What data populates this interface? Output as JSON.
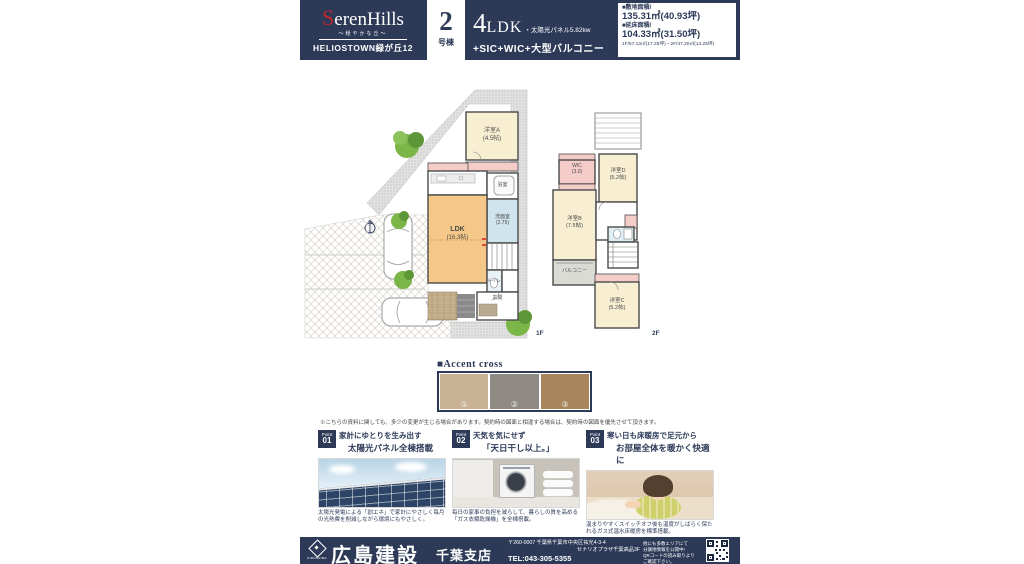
{
  "colors": {
    "navy": "#2c3a58",
    "brand_red": "#c0272d",
    "room_cream": "#f8efd3",
    "ldk_orange": "#f5c88a",
    "closet_pink": "#f5cdc8",
    "wet_area_blue": "#cfe4ec"
  },
  "header": {
    "brand_initial": "S",
    "brand_rest": "erenHills",
    "brand_tagline": "〜穏やかな丘〜",
    "brand_series": "HELIOSTOWN緑が丘12",
    "unit_number": "2",
    "unit_suffix": "号棟",
    "plan_number": "4",
    "plan_type": "LDK",
    "plan_solar": "・太陽光パネル5.82kw",
    "plan_features": "+SIC+WIC+大型バルコニー",
    "area_land_label": "■敷地面積/",
    "area_land_value": "135.31㎡(40.93坪)",
    "area_floor_label": "■延床面積/",
    "area_floor_value": "104.33㎡(31.50坪)",
    "area_detail": "1F/57.13㎡(17.25坪)・2F/47.20㎡(14.25坪)"
  },
  "floorplan": {
    "f1_label": "1F",
    "f2_label": "2F",
    "f1_rooms": {
      "room_a": {
        "name": "洋室A",
        "size": "(4.5帖)"
      },
      "ldk": {
        "name": "LDK",
        "size": "(16.3帖)"
      },
      "bath": {
        "name": "浴室",
        "size": ""
      },
      "washroom": {
        "name": "洗面室",
        "size": "(2.75)"
      },
      "toilet": {
        "name": "トイレ",
        "size": ""
      },
      "entrance": {
        "name": "玄関",
        "size": ""
      }
    },
    "f2_rooms": {
      "wic": {
        "name": "WIC",
        "size": "(3.0)"
      },
      "room_d": {
        "name": "洋室D",
        "size": "(5.2帖)"
      },
      "room_b": {
        "name": "洋室B",
        "size": "(7.5帖)"
      },
      "balcony": {
        "name": "バルコニー",
        "size": ""
      },
      "room_c": {
        "name": "洋室C",
        "size": "(5.2帖)"
      }
    }
  },
  "accent": {
    "title": "■Accent cross",
    "swatches": [
      {
        "label": "①",
        "color": "#c9b394"
      },
      {
        "label": "②",
        "color": "#8f8a84"
      },
      {
        "label": "③",
        "color": "#a8855a"
      }
    ],
    "disclaimer": "※こちらの資料に関しても、多少の変更が生じる場合があります。契約時の図面と相違する場合は、契約時の図面を優先させて頂きます。"
  },
  "points": [
    {
      "badge_label": "Point",
      "badge_num": "01",
      "title_line1": "家計にゆとりを生み出す",
      "title_line2": "太陽光パネル全棟搭載",
      "caption": "太陽光発電による「創エネ」で家計にやさしく毎月の光熱費を削減しながら環境にもやさしく。"
    },
    {
      "badge_label": "Point",
      "badge_num": "02",
      "title_line1": "天気を気にせず",
      "title_line2": "「天日干し以上。」",
      "caption": "毎日の家事の負担を減らして、暮らしの質を高める「ガス衣類乾燥機」を全棟搭載。"
    },
    {
      "badge_label": "Point",
      "badge_num": "03",
      "title_line1": "寒い日も床暖房で足元から",
      "title_line2": "お部屋全体を暖かく快適に",
      "caption": "温まりやすくスイッチオフ後も温度がしばらく保たれるガス式温水床暖房を標準搭載。"
    }
  ],
  "footer": {
    "company": "広島建設",
    "branch": "千葉支店",
    "logo_mark": "HIROSHIMA",
    "address_line1": "〒260-0007 千葉県千葉市中央区祐光4-3-4",
    "address_line2": "セナリオプラザ千葉高品3F",
    "tel": "TEL:043-305-5355",
    "promo_line1": "他にも多数エリアにて",
    "promo_line2": "分譲地情報を公開中!",
    "promo_line3": "QRコードの読み取りより",
    "promo_line4": "ご確認下さい。"
  }
}
